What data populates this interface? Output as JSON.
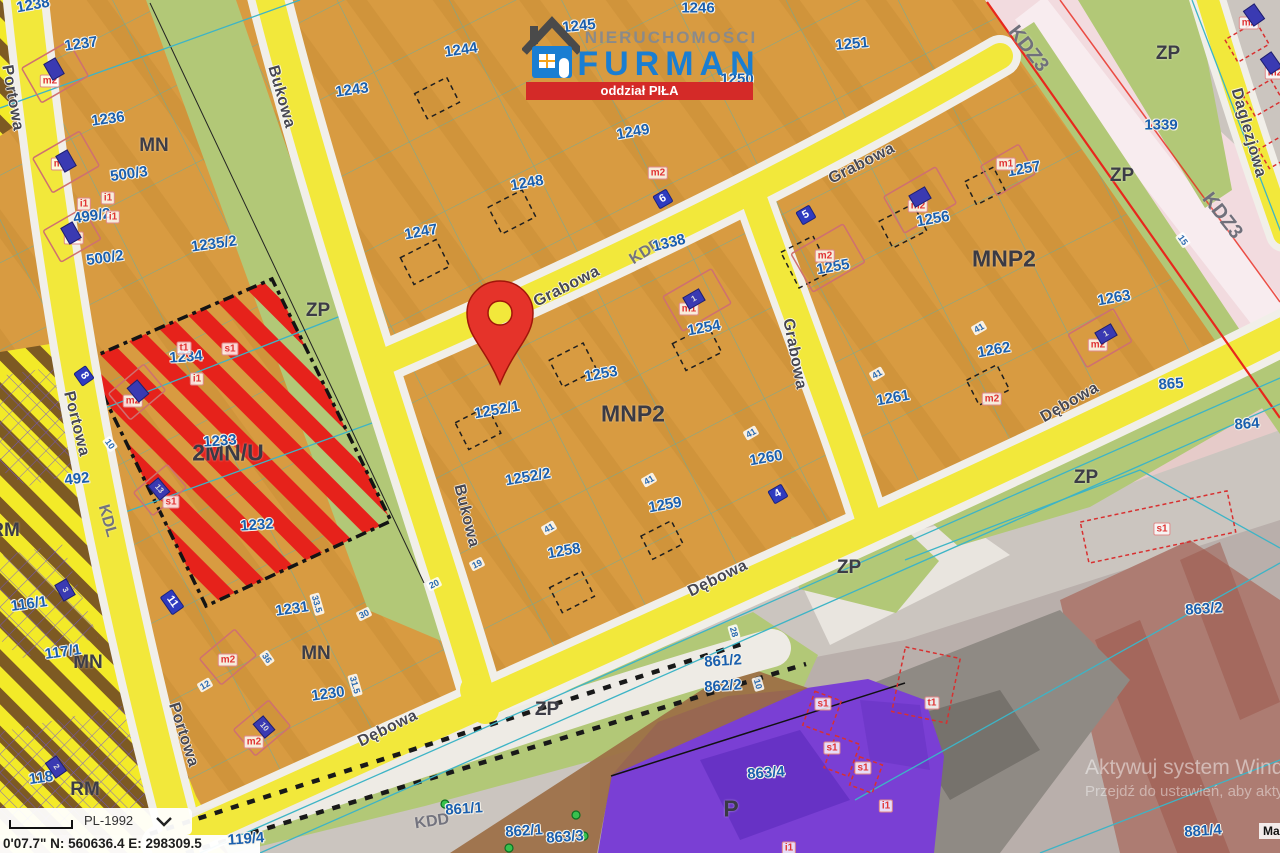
{
  "logo": {
    "line1": "NIERUCHOMOŚCI",
    "line2": "FURMAN",
    "banner": "oddział PIŁA"
  },
  "status_bar": {
    "crs": "PL-1992",
    "coords": "0'07.7\"  N: 560636.4  E: 298309.5"
  },
  "watermark": {
    "line1": "Aktywuj system Wind",
    "line2": "Przejdź do ustawień, aby akty"
  },
  "attribution": "Ma",
  "colors": {
    "zone_residential_orange": "#d89b41",
    "zone_green_zp": "#b2c877",
    "road_yellow": "#f2e83b",
    "road_casing_white": "#f1efe9",
    "road_pink_kdz": "#f2dbdf",
    "zone_red_stripe": "#e6221b",
    "zone_yellow_stripe": "#f3ea28",
    "zone_brown_stripe": "#7d5a23",
    "zone_purple_p": "#7a3fd4",
    "parcel_text_blue": "#1a5fae",
    "teal_parcel_line": "#3db4c6",
    "pin_red": "#e5332a",
    "logo_blue": "#1a7ed2",
    "banner_red": "#d42a28",
    "badge_blue": "#2f3bbf"
  },
  "pin": {
    "x": 500,
    "y": 384
  },
  "label_format": "[text, x, y, rotation_deg, class]",
  "map": {
    "labels": [
      [
        "Portowa",
        12,
        98,
        80,
        "street"
      ],
      [
        "Portowa",
        76,
        424,
        76,
        "street"
      ],
      [
        "Portowa",
        183,
        735,
        72,
        "street"
      ],
      [
        "Bukowa",
        281,
        97,
        74,
        "street"
      ],
      [
        "Bukowa",
        466,
        516,
        76,
        "street"
      ],
      [
        "Grabowa",
        567,
        287,
        -27,
        "street"
      ],
      [
        "Grabowa",
        862,
        164,
        -27,
        "street"
      ],
      [
        "Grabowa",
        794,
        354,
        79,
        "street"
      ],
      [
        "Dębowa",
        388,
        729,
        -26,
        "street"
      ],
      [
        "Dębowa",
        718,
        579,
        -26,
        "street"
      ],
      [
        "Dębowa",
        1070,
        403,
        -30,
        "street"
      ],
      [
        "Daglezjowa",
        1248,
        133,
        74,
        "street"
      ],
      [
        "KDD",
        646,
        252,
        -32,
        "roadclass"
      ],
      [
        "KDD",
        432,
        822,
        -8,
        "roadclass"
      ],
      [
        "KDL",
        107,
        521,
        74,
        "roadclass"
      ],
      [
        "KDZ3",
        1028,
        49,
        52,
        "roadclass-lg"
      ],
      [
        "KDZ3",
        1222,
        216,
        52,
        "roadclass-lg"
      ],
      [
        "MN",
        154,
        146,
        0,
        "zone"
      ],
      [
        "MN",
        88,
        663,
        0,
        "zone"
      ],
      [
        "MN",
        316,
        654,
        0,
        "zone"
      ],
      [
        "MNP2",
        633,
        414,
        0,
        "zone-lg"
      ],
      [
        "MNP2",
        1004,
        259,
        0,
        "zone-lg"
      ],
      [
        "2MN/U",
        228,
        453,
        0,
        "zone-lg"
      ],
      [
        "ZP",
        318,
        311,
        0,
        "zone"
      ],
      [
        "ZP",
        547,
        710,
        0,
        "zone"
      ],
      [
        "ZP",
        849,
        568,
        0,
        "zone"
      ],
      [
        "ZP",
        1086,
        478,
        0,
        "zone"
      ],
      [
        "ZP",
        1168,
        54,
        0,
        "zone"
      ],
      [
        "ZP",
        1122,
        176,
        0,
        "zone"
      ],
      [
        "RM",
        85,
        790,
        0,
        "zone"
      ],
      [
        "RM",
        5,
        531,
        0,
        "zone"
      ],
      [
        "P",
        731,
        809,
        0,
        "zone-lg"
      ],
      [
        "1238",
        33,
        5,
        -10,
        "parcel"
      ],
      [
        "1237",
        81,
        44,
        -8,
        "parcel"
      ],
      [
        "1236",
        108,
        119,
        -8,
        "parcel"
      ],
      [
        "500/3",
        129,
        174,
        -8,
        "parcel"
      ],
      [
        "499/2",
        92,
        216,
        -8,
        "parcel"
      ],
      [
        "500/2",
        105,
        258,
        -8,
        "parcel"
      ],
      [
        "1235/2",
        214,
        244,
        -8,
        "parcel"
      ],
      [
        "1243",
        352,
        90,
        -8,
        "parcel"
      ],
      [
        "1244",
        461,
        50,
        -8,
        "parcel"
      ],
      [
        "1245",
        579,
        26,
        -6,
        "parcel"
      ],
      [
        "1246",
        698,
        8,
        0,
        "parcel"
      ],
      [
        "1250",
        737,
        79,
        0,
        "parcel"
      ],
      [
        "1251",
        852,
        44,
        -5,
        "parcel"
      ],
      [
        "1247",
        421,
        232,
        -10,
        "parcel"
      ],
      [
        "1248",
        527,
        183,
        -10,
        "parcel"
      ],
      [
        "1249",
        633,
        132,
        -10,
        "parcel"
      ],
      [
        "1338",
        669,
        243,
        -14,
        "parcel"
      ],
      [
        "1252/1",
        497,
        410,
        -10,
        "parcel"
      ],
      [
        "1252/2",
        528,
        477,
        -10,
        "parcel"
      ],
      [
        "1253",
        601,
        374,
        -10,
        "parcel"
      ],
      [
        "1254",
        704,
        328,
        -10,
        "parcel"
      ],
      [
        "1258",
        564,
        551,
        -10,
        "parcel"
      ],
      [
        "1259",
        665,
        505,
        -10,
        "parcel"
      ],
      [
        "1260",
        766,
        458,
        -10,
        "parcel"
      ],
      [
        "1255",
        833,
        267,
        -10,
        "parcel"
      ],
      [
        "1256",
        933,
        219,
        -10,
        "parcel"
      ],
      [
        "1257",
        1024,
        169,
        -10,
        "parcel"
      ],
      [
        "1261",
        893,
        398,
        -10,
        "parcel"
      ],
      [
        "1262",
        994,
        350,
        -10,
        "parcel"
      ],
      [
        "1263",
        1114,
        298,
        -10,
        "parcel"
      ],
      [
        "1339",
        1161,
        125,
        0,
        "parcel"
      ],
      [
        "1233",
        220,
        441,
        -4,
        "parcel"
      ],
      [
        "1234",
        186,
        357,
        -4,
        "parcel"
      ],
      [
        "1232",
        257,
        525,
        -4,
        "parcel"
      ],
      [
        "492",
        77,
        479,
        -6,
        "parcel"
      ],
      [
        "1231",
        292,
        609,
        -8,
        "parcel"
      ],
      [
        "1230",
        328,
        694,
        -8,
        "parcel"
      ],
      [
        "116/1",
        29,
        604,
        -8,
        "parcel"
      ],
      [
        "117/1",
        63,
        652,
        -8,
        "parcel"
      ],
      [
        "118",
        41,
        778,
        -8,
        "parcel"
      ],
      [
        "861/2",
        723,
        661,
        -4,
        "parcel"
      ],
      [
        "862/2",
        723,
        686,
        -4,
        "parcel"
      ],
      [
        "861/1",
        464,
        809,
        -4,
        "parcel"
      ],
      [
        "862/1",
        524,
        831,
        -4,
        "parcel"
      ],
      [
        "863/3",
        565,
        837,
        -4,
        "parcel"
      ],
      [
        "863/4",
        766,
        773,
        -4,
        "parcel"
      ],
      [
        "863/2",
        1204,
        609,
        -4,
        "parcel"
      ],
      [
        "865",
        1171,
        384,
        -4,
        "parcel"
      ],
      [
        "864",
        1247,
        424,
        -4,
        "parcel"
      ],
      [
        "881/4",
        1203,
        831,
        -4,
        "parcel"
      ],
      [
        "119/4",
        246,
        839,
        -4,
        "parcel"
      ],
      [
        "m2",
        50,
        81,
        0,
        "marker"
      ],
      [
        "m2",
        61,
        164,
        0,
        "marker"
      ],
      [
        "m2",
        74,
        238,
        0,
        "marker"
      ],
      [
        "m2",
        133,
        401,
        0,
        "marker"
      ],
      [
        "m2",
        658,
        173,
        0,
        "marker"
      ],
      [
        "m2",
        825,
        256,
        0,
        "marker"
      ],
      [
        "m2",
        918,
        206,
        0,
        "marker"
      ],
      [
        "m2",
        992,
        399,
        0,
        "marker"
      ],
      [
        "m2",
        1098,
        345,
        0,
        "marker"
      ],
      [
        "m2",
        228,
        660,
        0,
        "marker"
      ],
      [
        "m2",
        254,
        742,
        0,
        "marker"
      ],
      [
        "m2",
        1249,
        23,
        0,
        "marker"
      ],
      [
        "m2",
        1275,
        73,
        0,
        "marker"
      ],
      [
        "m1",
        689,
        309,
        0,
        "marker"
      ],
      [
        "m1",
        1006,
        164,
        0,
        "marker"
      ],
      [
        "s1",
        230,
        349,
        0,
        "marker"
      ],
      [
        "s1",
        171,
        502,
        0,
        "marker"
      ],
      [
        "s1",
        1162,
        529,
        0,
        "marker"
      ],
      [
        "s1",
        823,
        704,
        0,
        "marker"
      ],
      [
        "s1",
        832,
        748,
        0,
        "marker"
      ],
      [
        "s1",
        863,
        768,
        0,
        "marker"
      ],
      [
        "i1",
        84,
        204,
        0,
        "marker"
      ],
      [
        "i1",
        108,
        198,
        0,
        "marker"
      ],
      [
        "i1",
        113,
        217,
        0,
        "marker"
      ],
      [
        "i1",
        197,
        379,
        0,
        "marker"
      ],
      [
        "i1",
        886,
        806,
        0,
        "marker"
      ],
      [
        "i1",
        789,
        848,
        0,
        "marker"
      ],
      [
        "t1",
        184,
        348,
        0,
        "marker"
      ],
      [
        "t1",
        932,
        703,
        0,
        "marker"
      ],
      [
        "6",
        663,
        199,
        -30,
        "badge"
      ],
      [
        "5",
        806,
        215,
        -30,
        "badge"
      ],
      [
        "4",
        778,
        494,
        -30,
        "badge"
      ],
      [
        "11",
        172,
        602,
        55,
        "badge"
      ],
      [
        "8",
        84,
        376,
        55,
        "badge"
      ],
      [
        "",
        54,
        69,
        60,
        "bldg"
      ],
      [
        "",
        66,
        161,
        60,
        "bldg"
      ],
      [
        "",
        71,
        233,
        60,
        "bldg"
      ],
      [
        "3",
        65,
        590,
        60,
        "bldg"
      ],
      [
        "2",
        56,
        767,
        55,
        "bldg"
      ],
      [
        "13",
        159,
        489,
        50,
        "bldg"
      ],
      [
        "10",
        264,
        727,
        50,
        "bldg"
      ],
      [
        "1",
        694,
        299,
        -30,
        "bldg"
      ],
      [
        "",
        920,
        197,
        -30,
        "bldg"
      ],
      [
        "1",
        1106,
        334,
        -30,
        "bldg"
      ],
      [
        "",
        138,
        391,
        50,
        "bldg"
      ],
      [
        "",
        1254,
        15,
        55,
        "bldg"
      ],
      [
        "",
        1271,
        63,
        55,
        "bldg"
      ],
      [
        "41",
        649,
        480,
        -30,
        "dim"
      ],
      [
        "41",
        751,
        433,
        -30,
        "dim"
      ],
      [
        "41",
        549,
        528,
        -30,
        "dim"
      ],
      [
        "41",
        979,
        328,
        -30,
        "dim"
      ],
      [
        "41",
        877,
        374,
        -30,
        "dim"
      ],
      [
        "30",
        364,
        614,
        -26,
        "dim"
      ],
      [
        "20",
        434,
        584,
        -26,
        "dim"
      ],
      [
        "19",
        477,
        564,
        -26,
        "dim"
      ],
      [
        "33.5",
        317,
        604,
        74,
        "dim"
      ],
      [
        "31.5",
        355,
        685,
        74,
        "dim"
      ],
      [
        "12",
        205,
        685,
        -30,
        "dim"
      ],
      [
        "36",
        267,
        658,
        55,
        "dim"
      ],
      [
        "10",
        110,
        444,
        55,
        "dim"
      ],
      [
        "10",
        758,
        684,
        74,
        "dim"
      ],
      [
        "28",
        734,
        632,
        74,
        "dim"
      ],
      [
        "15",
        1183,
        240,
        55,
        "dim"
      ]
    ]
  }
}
